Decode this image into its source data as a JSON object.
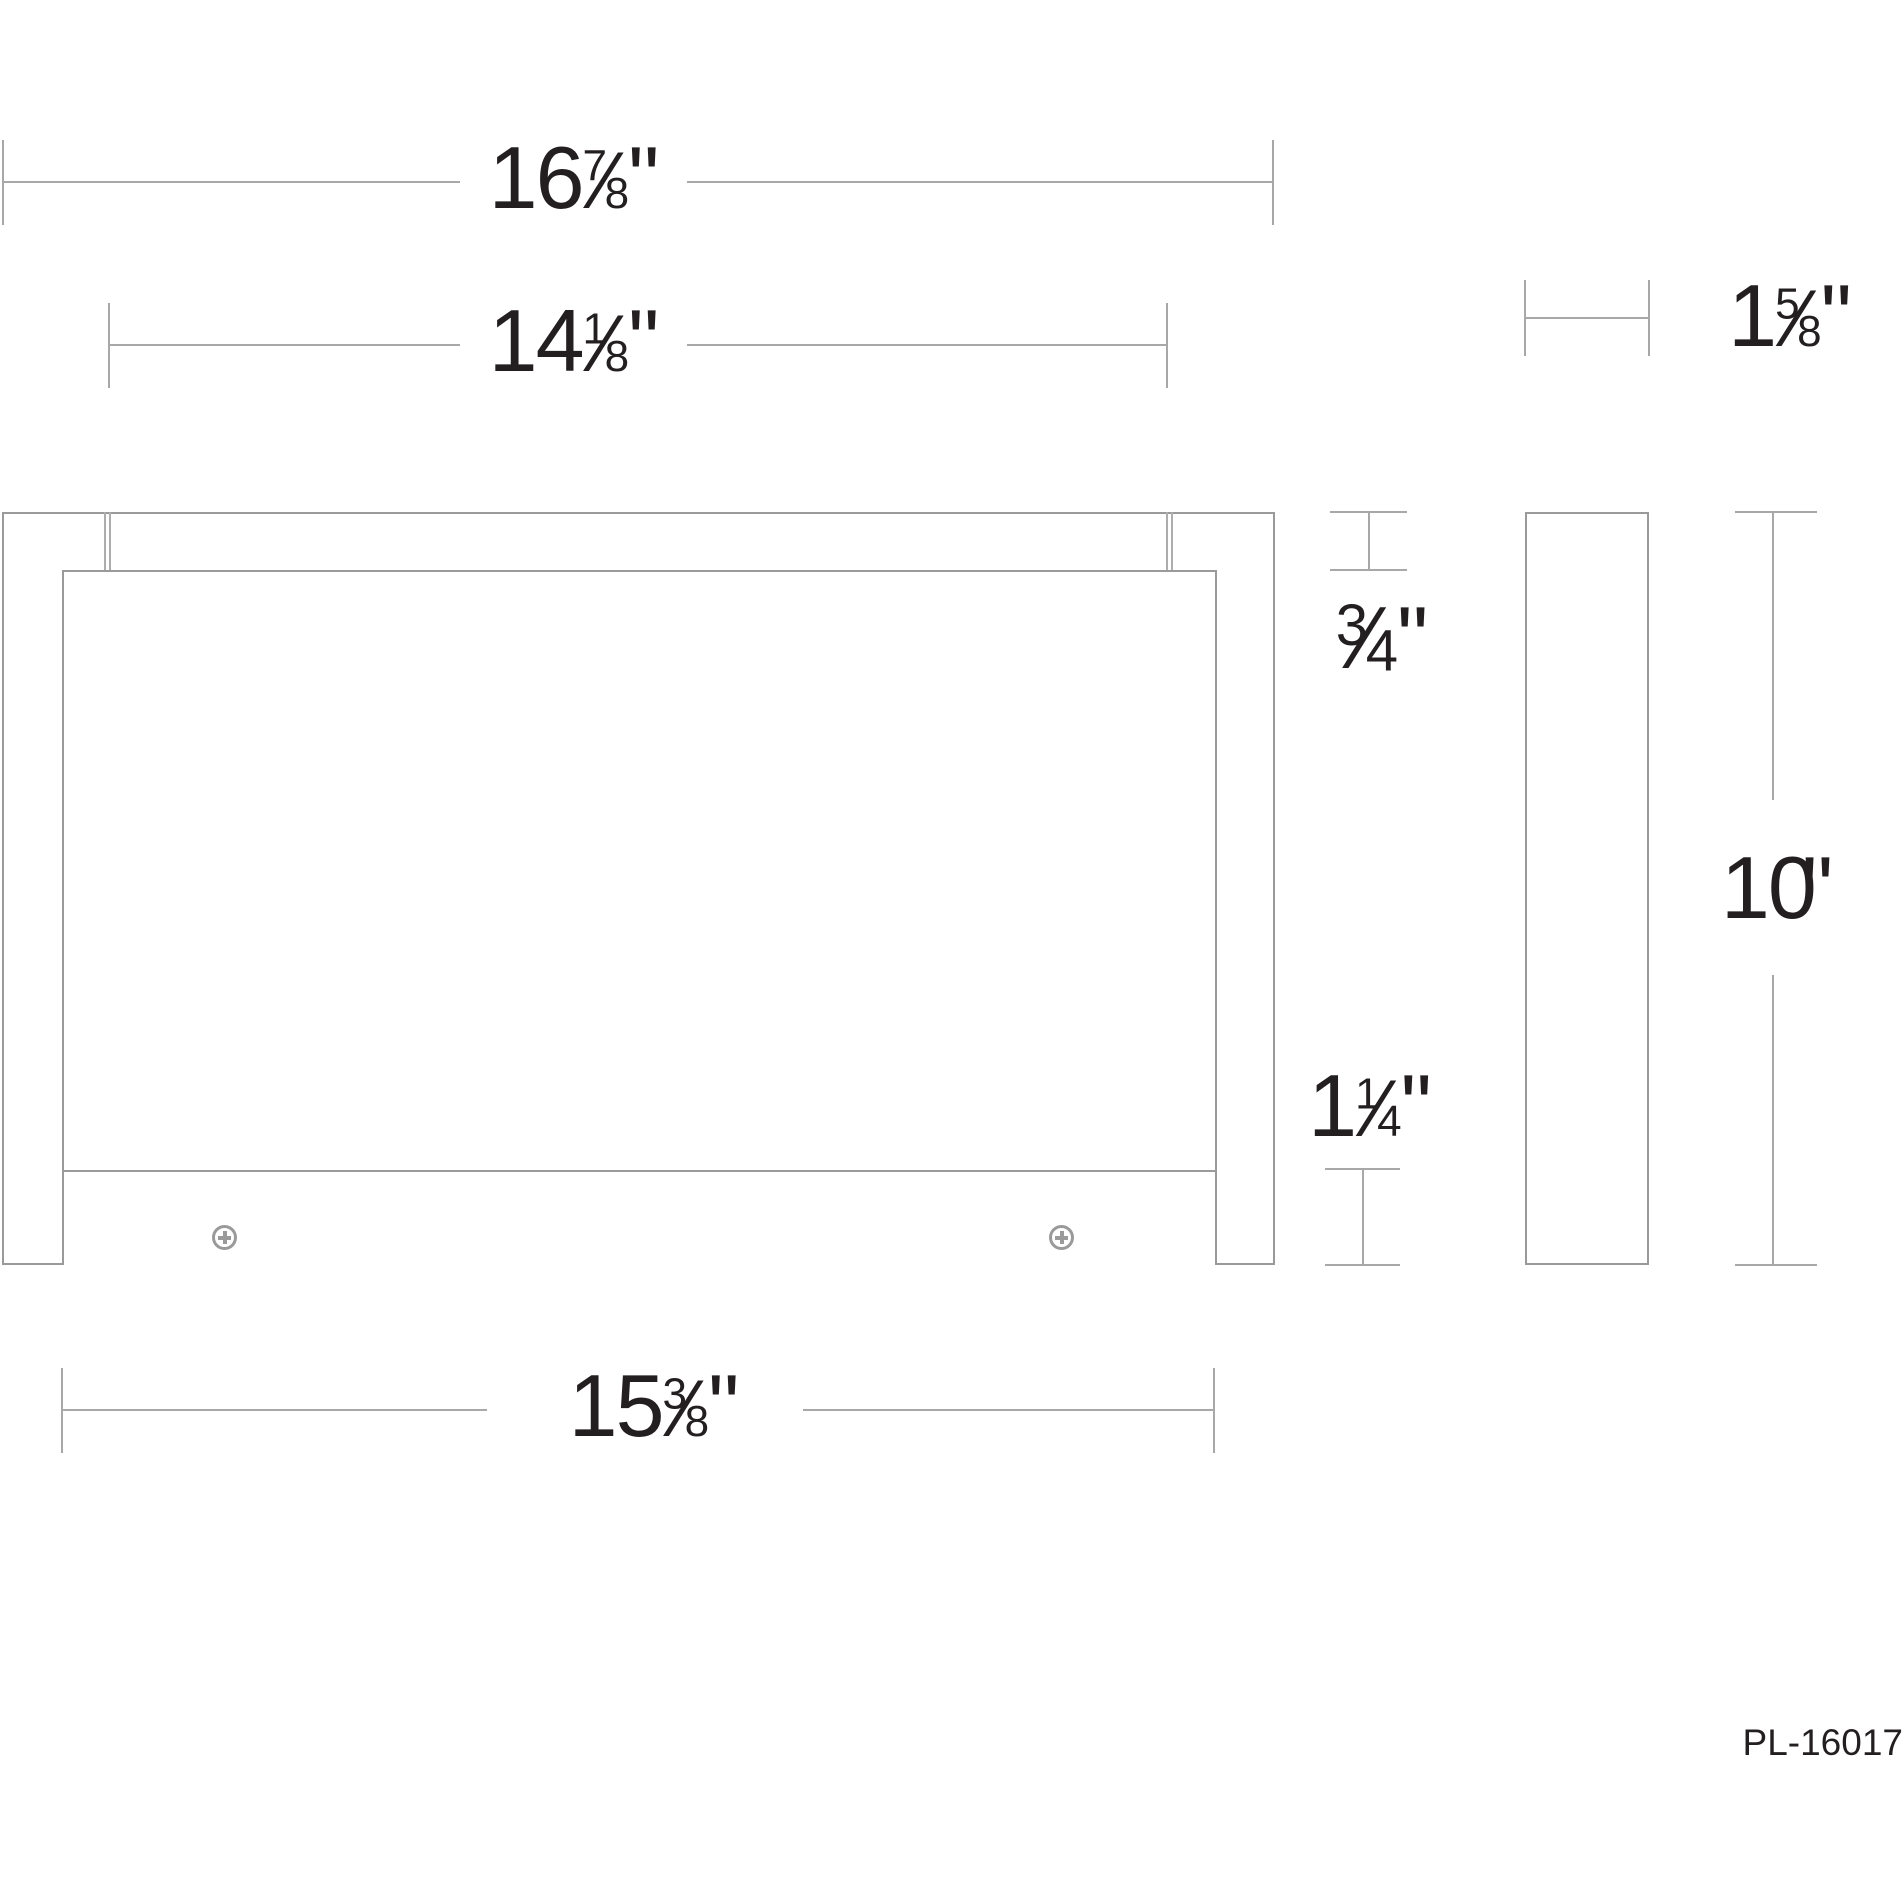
{
  "drawing": {
    "title": "luminaire-dimension-drawing",
    "part_number": "PL-16017",
    "unit_mark": "\"",
    "colors": {
      "fixture_line": "#9a9a9a",
      "dimension_line": "#a8a8a8",
      "text": "#231f20"
    },
    "dimensions": {
      "overall_width": {
        "whole": "16",
        "num": "7",
        "slash": "⁄",
        "den": "8",
        "unit": "\""
      },
      "rail_width": {
        "whole": "14",
        "num": "1",
        "slash": "⁄",
        "den": "8",
        "unit": "\""
      },
      "panel_width": {
        "whole": "15",
        "num": "3",
        "slash": "⁄",
        "den": "8",
        "unit": "\""
      },
      "rail_height": {
        "whole": "",
        "num": "3",
        "slash": "⁄",
        "den": "4",
        "unit": "\""
      },
      "bottom_bar_height": {
        "whole": "1",
        "num": "1",
        "slash": "⁄",
        "den": "4",
        "unit": "\""
      },
      "depth": {
        "whole": "1",
        "num": "5",
        "slash": "⁄",
        "den": "8",
        "unit": "\""
      },
      "overall_height": {
        "whole": "10",
        "num": "",
        "slash": "",
        "den": "",
        "unit": "\""
      }
    }
  }
}
